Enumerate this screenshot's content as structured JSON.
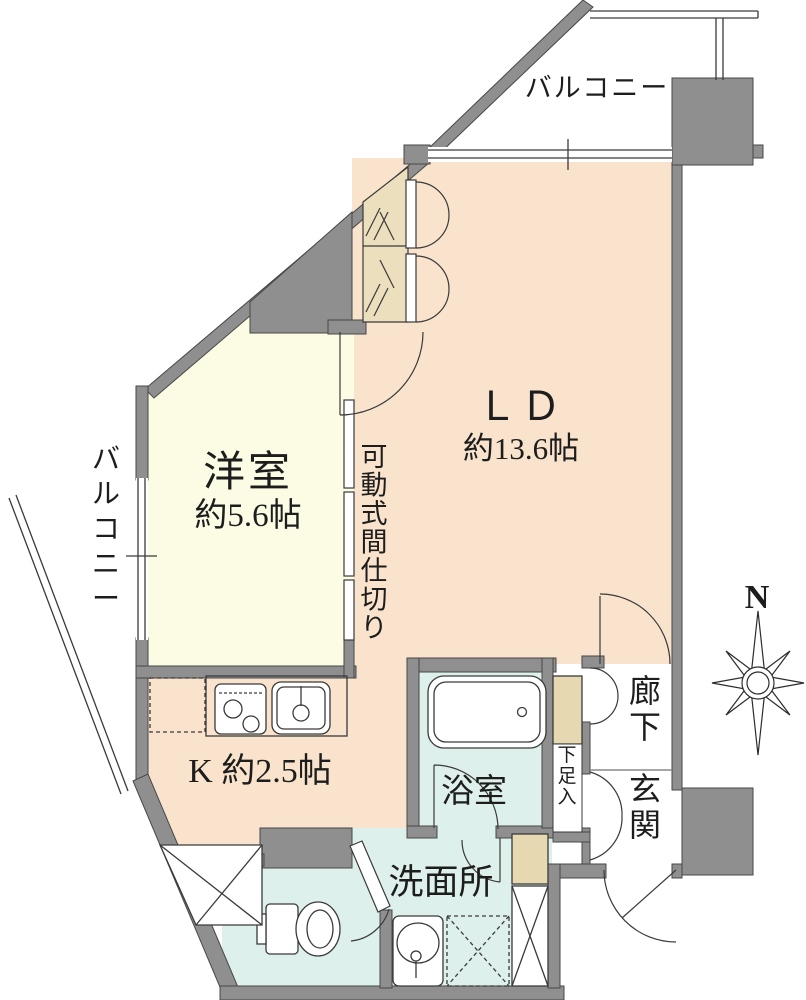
{
  "plan": {
    "labels": {
      "balcony_top": "バルコニー",
      "balcony_left": "バルコニー",
      "ld_name": "ＬＤ",
      "ld_size": "約13.6帖",
      "bedroom_name": "洋室",
      "bedroom_size": "約5.6帖",
      "kitchen": "K 約2.5帖",
      "partition": "可動式間仕切り",
      "bath": "浴室",
      "washroom": "洗面所",
      "hallway": "廊下",
      "entrance": "玄関",
      "shoe_cabinet": "下足入",
      "compass_n": "N"
    },
    "colors": {
      "wall": "#8f8f8f",
      "wall_edge": "#474747",
      "floor_ldk": "#f9e3cc",
      "floor_bedroom": "#fcfbe4",
      "floor_wet": "#def0eb",
      "closet_fill": "#ebdfbe",
      "cabinet_fill": "#e6d8b0",
      "line": "#3a3a3a",
      "text": "#1d1d1d"
    }
  }
}
